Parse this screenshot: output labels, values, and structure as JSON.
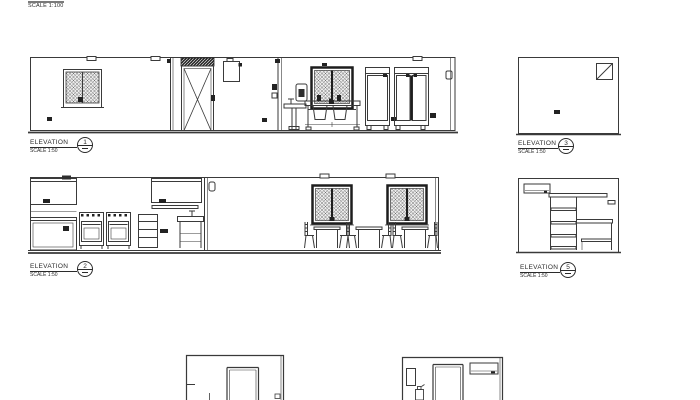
{
  "plan_title": {
    "scale": "SCALE 1:100"
  },
  "elevations": [
    {
      "name": "ELEVATION",
      "scale": "SCALE 1:50",
      "number": "1"
    },
    {
      "name": "ELEVATION",
      "scale": "SCALE 1:50",
      "number": "2"
    },
    {
      "name": "ELEVATION",
      "scale": "SCALE 1:50",
      "number": "3"
    },
    {
      "name": "ELEVATION",
      "scale": "SCALE 1:50",
      "number": "5"
    }
  ],
  "colors": {
    "line": "#3a3a3a",
    "dark_frame": "#1d1d1d",
    "paper": "#ffffff"
  }
}
